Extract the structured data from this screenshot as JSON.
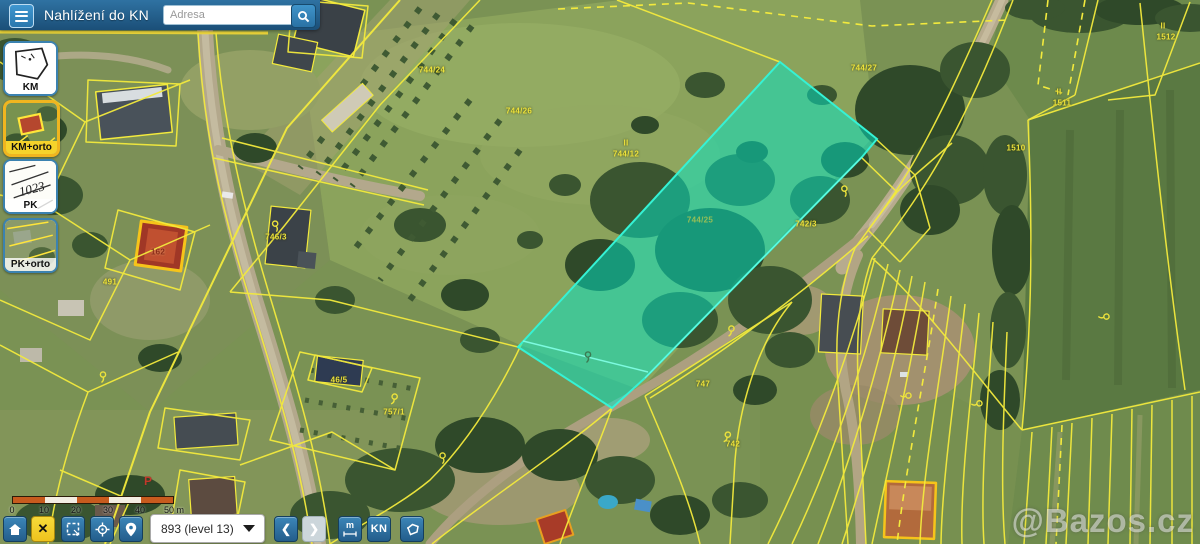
{
  "header": {
    "title": "Nahlížení do KN",
    "search_placeholder": "Adresa"
  },
  "icons": {
    "hamburger": "menu",
    "search": "magnifier",
    "home": "home",
    "close": "✕",
    "select": "selection-box",
    "locate": "crosshair",
    "marker": "map-pin",
    "back": "❮",
    "forward": "❯",
    "measure": "ruler",
    "polygon": "lasso",
    "kn": "KN"
  },
  "layer_switcher": {
    "items": [
      {
        "label": "KM",
        "active": false
      },
      {
        "label": "KM+orto",
        "active": true
      },
      {
        "label": "PK",
        "active": false
      },
      {
        "label": "PK+orto",
        "active": false
      }
    ]
  },
  "scale_bar": {
    "ticks": [
      "0",
      "10",
      "20",
      "30",
      "40"
    ],
    "end_label": "50 m"
  },
  "toolbar": {
    "zoom_value": "893 (level 13)",
    "kn_label": "KN",
    "measure_label": "m"
  },
  "watermark": "@Bazos.cz",
  "map": {
    "highlight_color": "#2ef0d0",
    "parcel_line_color": "#f3ea3d",
    "labels": [
      {
        "text": "744/26",
        "x": 519,
        "y": 111
      },
      {
        "text": "II",
        "x": 626,
        "y": 143
      },
      {
        "text": "744/12",
        "x": 626,
        "y": 154
      },
      {
        "text": "744/25",
        "x": 700,
        "y": 220,
        "variant": "muted"
      },
      {
        "text": "744/27",
        "x": 864,
        "y": 68
      },
      {
        "text": "744/24",
        "x": 432,
        "y": 70
      },
      {
        "text": "742/3",
        "x": 806,
        "y": 224
      },
      {
        "text": "747",
        "x": 703,
        "y": 384
      },
      {
        "text": "742",
        "x": 733,
        "y": 444
      },
      {
        "text": "II",
        "x": 1163,
        "y": 26
      },
      {
        "text": "1512",
        "x": 1166,
        "y": 37
      },
      {
        "text": "II",
        "x": 1059,
        "y": 92
      },
      {
        "text": "1511",
        "x": 1062,
        "y": 103
      },
      {
        "text": "1510",
        "x": 1016,
        "y": 148
      },
      {
        "text": "746/3",
        "x": 276,
        "y": 237
      },
      {
        "text": "162",
        "x": 158,
        "y": 252,
        "variant": "red"
      },
      {
        "text": "491",
        "x": 110,
        "y": 282
      },
      {
        "text": "46/5",
        "x": 339,
        "y": 380
      },
      {
        "text": "757/1",
        "x": 394,
        "y": 412
      }
    ],
    "symbols": [
      {
        "x": 394,
        "y": 399,
        "rot": 15,
        "name": "tree-symbol"
      },
      {
        "x": 443,
        "y": 458,
        "rot": -10,
        "name": "tree-symbol"
      },
      {
        "x": 727,
        "y": 437,
        "rot": 20,
        "name": "tree-symbol"
      },
      {
        "x": 906,
        "y": 396,
        "rot": 80,
        "name": "tree-symbol"
      },
      {
        "x": 977,
        "y": 404,
        "rot": 75,
        "name": "tree-symbol"
      },
      {
        "x": 1104,
        "y": 317,
        "rot": 80,
        "name": "tree-symbol"
      },
      {
        "x": 731,
        "y": 331,
        "rot": 10,
        "name": "tree-symbol"
      },
      {
        "x": 845,
        "y": 191,
        "rot": -15,
        "name": "tree-symbol"
      },
      {
        "x": 103,
        "y": 377,
        "rot": 0,
        "name": "tree-symbol"
      },
      {
        "x": 276,
        "y": 226,
        "rot": -20,
        "name": "tree-symbol"
      },
      {
        "x": 588,
        "y": 357,
        "rot": 0,
        "name": "tree-symbol",
        "variant": "dark"
      },
      {
        "x": 148,
        "y": 481,
        "glyph": "P",
        "variant": "red",
        "name": "red-p-symbol"
      }
    ]
  }
}
